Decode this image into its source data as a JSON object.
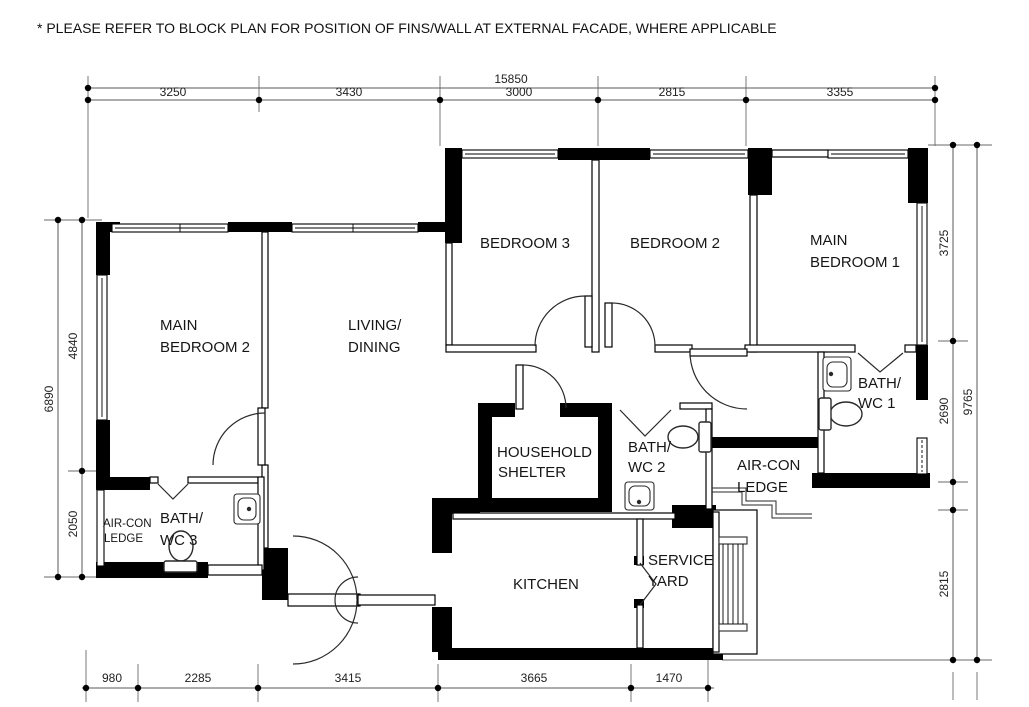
{
  "note": "* PLEASE REFER TO BLOCK PLAN FOR POSITION  OF FINS/WALL AT EXTERNAL FACADE, WHERE APPLICABLE",
  "rooms": {
    "main_bedroom_2": {
      "line1": "MAIN",
      "line2": "BEDROOM 2"
    },
    "living_dining": {
      "line1": "LIVING/",
      "line2": "DINING"
    },
    "bedroom_3": {
      "label": "BEDROOM 3"
    },
    "bedroom_2": {
      "label": "BEDROOM 2"
    },
    "main_bedroom_1": {
      "line1": "MAIN",
      "line2": "BEDROOM 1"
    },
    "bath_wc_1": {
      "line1": "BATH/",
      "line2": "WC 1"
    },
    "bath_wc_2": {
      "line1": "BATH/",
      "line2": "WC 2"
    },
    "bath_wc_3": {
      "line1": "BATH/",
      "line2": "WC 3"
    },
    "aircon_ledge_left": {
      "line1": "AIR-CON",
      "line2": "LEDGE"
    },
    "aircon_ledge_right": {
      "line1": "AIR-CON",
      "line2": "LEDGE"
    },
    "household_shelter": {
      "line1": "HOUSEHOLD",
      "line2": "SHELTER"
    },
    "kitchen": {
      "label": "KITCHEN"
    },
    "service_yard": {
      "line1": "SERVICE",
      "line2": "YARD"
    }
  },
  "dimensions": {
    "top": {
      "total": "15850",
      "segments": [
        "3250",
        "3430",
        "3000",
        "2815",
        "3355"
      ]
    },
    "left": {
      "total": "6890",
      "segments": [
        "4840",
        "2050"
      ]
    },
    "right": {
      "total": "9765",
      "segments": [
        "3725",
        "2690",
        "2815"
      ]
    },
    "bottom": {
      "segments": [
        "980",
        "2285",
        "3415",
        "3665",
        "1470"
      ]
    }
  },
  "colors": {
    "wall": "#000000",
    "line": "#5a5a5a",
    "text": "#161616",
    "background": "#ffffff"
  }
}
